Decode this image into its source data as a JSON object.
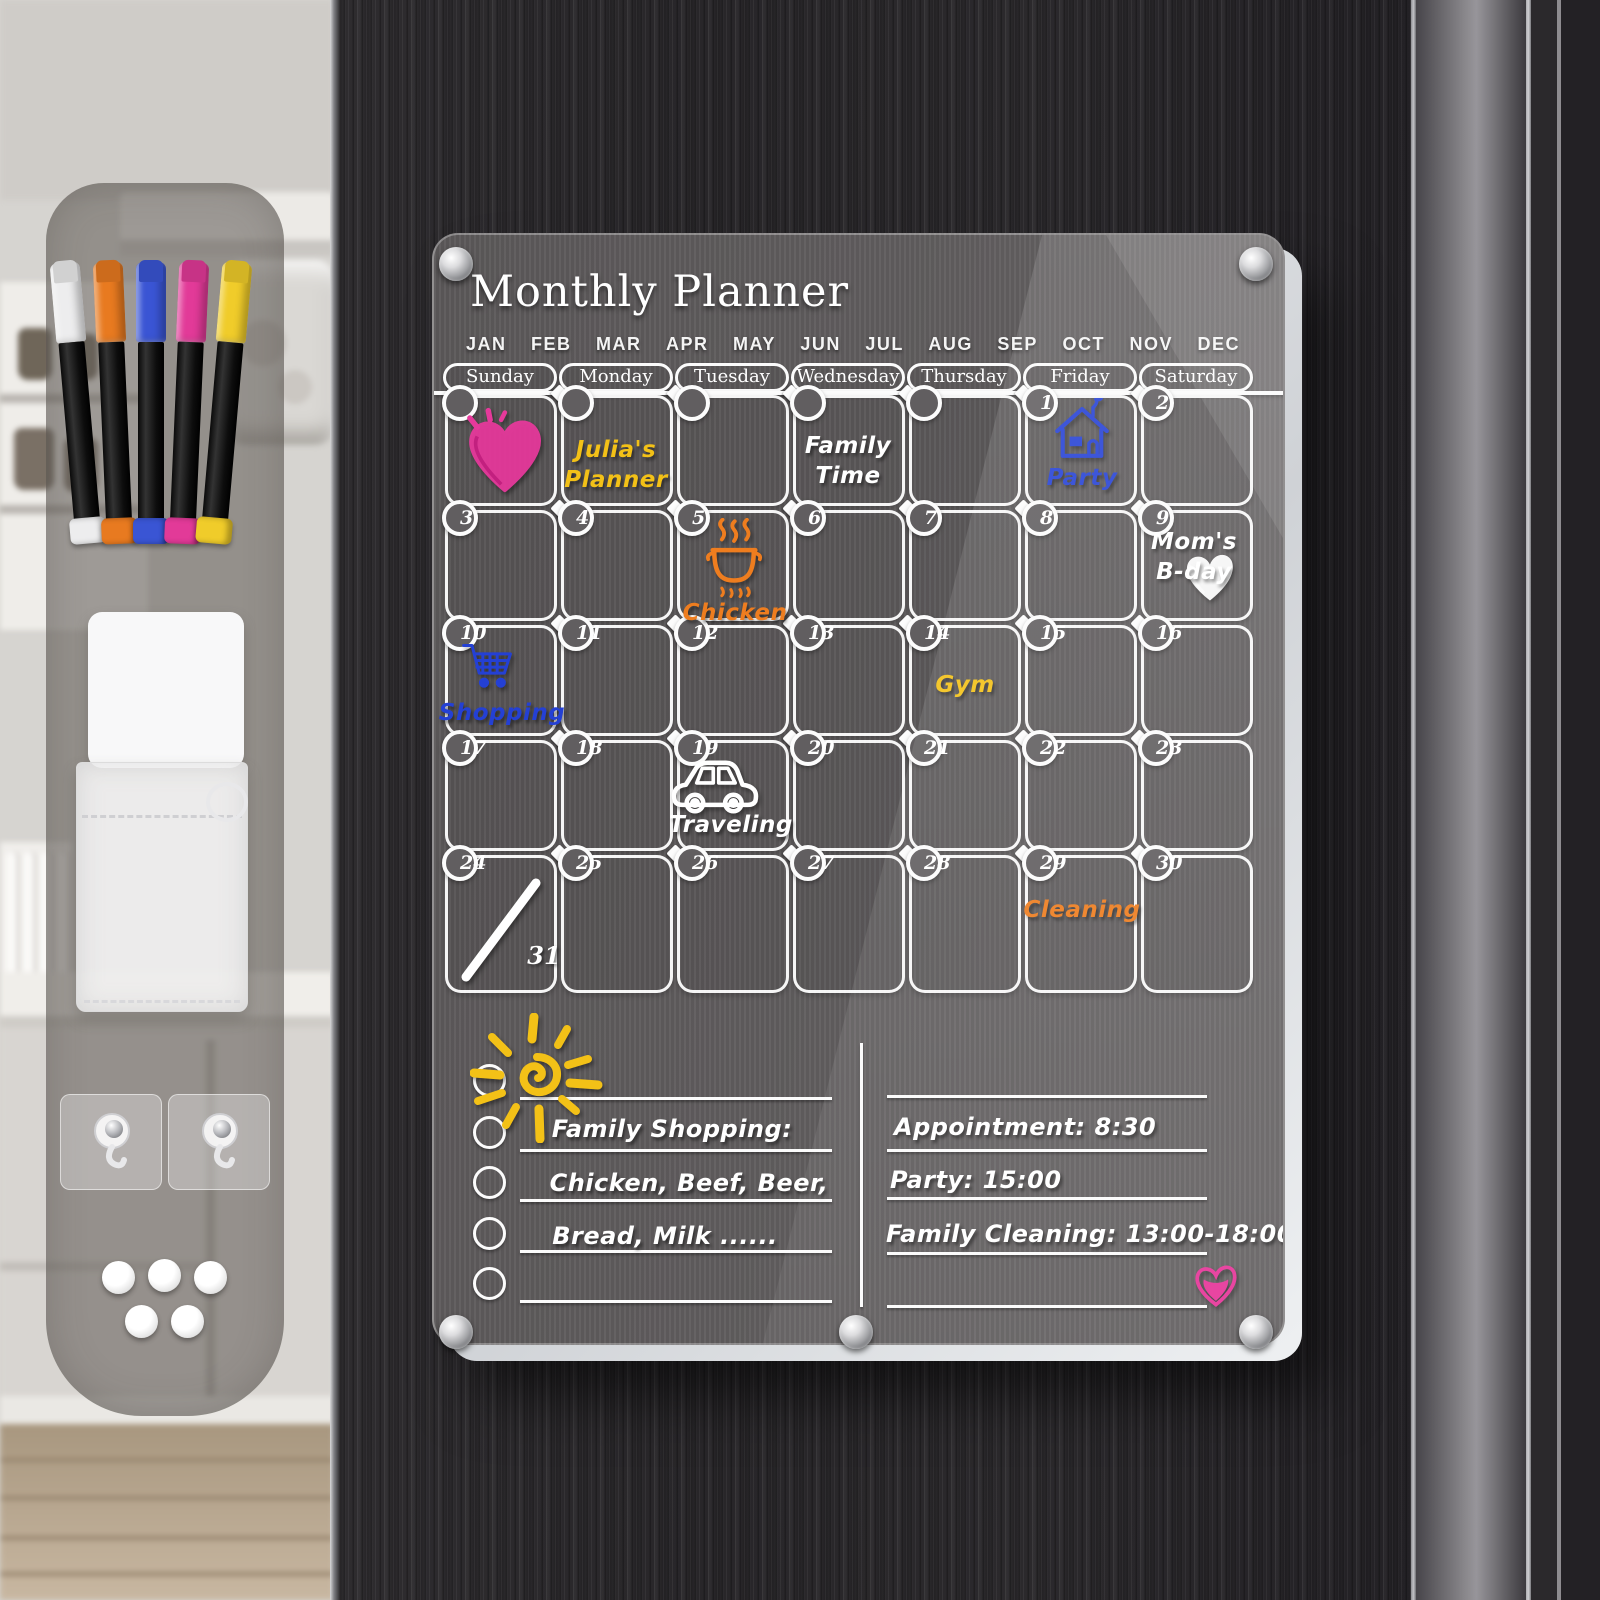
{
  "board": {
    "title": "Monthly Planner",
    "months": [
      "JAN",
      "FEB",
      "MAR",
      "APR",
      "MAY",
      "JUN",
      "JUL",
      "AUG",
      "SEP",
      "OCT",
      "NOV",
      "DEC"
    ],
    "weekdays": [
      "Sunday",
      "Monday",
      "Tuesday",
      "Wednesday",
      "Thursday",
      "Friday",
      "Saturday"
    ],
    "weeks": [
      [
        "",
        "",
        "",
        "",
        "",
        "1",
        "2"
      ],
      [
        "3",
        "4",
        "5",
        "6",
        "7",
        "8",
        "9"
      ],
      [
        "10",
        "11",
        "12",
        "13",
        "14",
        "15",
        "16"
      ],
      [
        "17",
        "18",
        "19",
        "20",
        "21",
        "22",
        "23"
      ],
      [
        "24",
        "25",
        "26",
        "27",
        "28",
        "29",
        "30"
      ]
    ],
    "overflow_date": "31",
    "entries": [
      {
        "week": 0,
        "day": 0,
        "icon": "heart-doodle-icon",
        "text": "",
        "color": "#e6399b"
      },
      {
        "week": 0,
        "day": 1,
        "text": "Julia's\nPlanner",
        "color": "#f3c117"
      },
      {
        "week": 0,
        "day": 3,
        "text": "Family\nTime",
        "color": "#ffffff"
      },
      {
        "week": 0,
        "day": 5,
        "icon": "house-icon",
        "text": "Party",
        "color": "#2440d4"
      },
      {
        "week": 1,
        "day": 2,
        "icon": "cooking-pot-icon",
        "text": "Chicken",
        "color": "#ee7d1f"
      },
      {
        "week": 1,
        "day": 6,
        "icon": "heart-small-icon",
        "text": "Mom's\nB-day",
        "color": "#ffffff"
      },
      {
        "week": 2,
        "day": 0,
        "icon": "shopping-cart-icon",
        "text": "Shopping",
        "color": "#2440d4"
      },
      {
        "week": 2,
        "day": 4,
        "text": "Gym",
        "color": "#f3c117"
      },
      {
        "week": 3,
        "day": 2,
        "icon": "car-icon",
        "text": "Traveling",
        "color": "#ffffff"
      },
      {
        "week": 4,
        "day": 0,
        "icon": "slash-mark",
        "text": "",
        "color": "#ffffff"
      },
      {
        "week": 4,
        "day": 5,
        "text": "Cleaning",
        "color": "#ee7d1f"
      }
    ],
    "notes_left": {
      "lines": [
        "",
        "Family Shopping:",
        "Chicken, Beef, Beer,",
        "Bread, Milk ......",
        ""
      ]
    },
    "notes_right": {
      "lines": [
        "",
        "Appointment: 8:30",
        "Party: 15:00",
        "Family Cleaning: 13:00-18:00",
        ""
      ]
    },
    "doodles": [
      "sun-doodle-icon",
      "heart-note-icon"
    ]
  },
  "accessories": {
    "markers": [
      {
        "name": "white-marker",
        "color": "#ededee"
      },
      {
        "name": "orange-marker",
        "color": "#e87a20"
      },
      {
        "name": "blue-marker",
        "color": "#3a55d4"
      },
      {
        "name": "pink-marker",
        "color": "#e23a98"
      },
      {
        "name": "yellow-marker",
        "color": "#f0cc2a"
      }
    ],
    "hooks_count": 2,
    "magnets_count": 5
  },
  "colors": {
    "accent_yellow": "#f3c117",
    "accent_blue": "#2440d4",
    "accent_orange": "#ee7d1f",
    "accent_pink": "#e6399b",
    "ink_white": "#ffffff",
    "fridge_dark": "#28262a",
    "board_gray": "#615e60"
  }
}
